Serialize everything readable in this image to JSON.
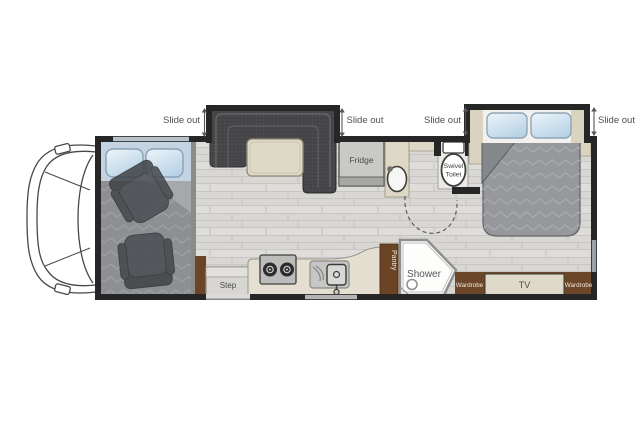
{
  "diagram": {
    "type": "rv-motorhome-floorplan",
    "slide_out_label": "Slide out",
    "fixtures": {
      "fridge": "Fridge",
      "swivel_toilet_line1": "Swivel",
      "swivel_toilet_line2": "Toilet",
      "shower": "Shower",
      "pantry": "Pantry",
      "step": "Step",
      "tv": "TV",
      "wardrobe_left": "Wardrobe",
      "wardrobe_right": "Wardrobe"
    },
    "colors": {
      "wall": "#262626",
      "floor": "#d8d7d4",
      "counter": "#e4dfd1",
      "cabinet_brown": "#6b4426",
      "booth": "#454547",
      "bed_blanket": "#96989b",
      "pillow_blue": "#cfe2f0",
      "table_beige": "#ded9c4",
      "label_gray": "#4f4f4f"
    }
  }
}
